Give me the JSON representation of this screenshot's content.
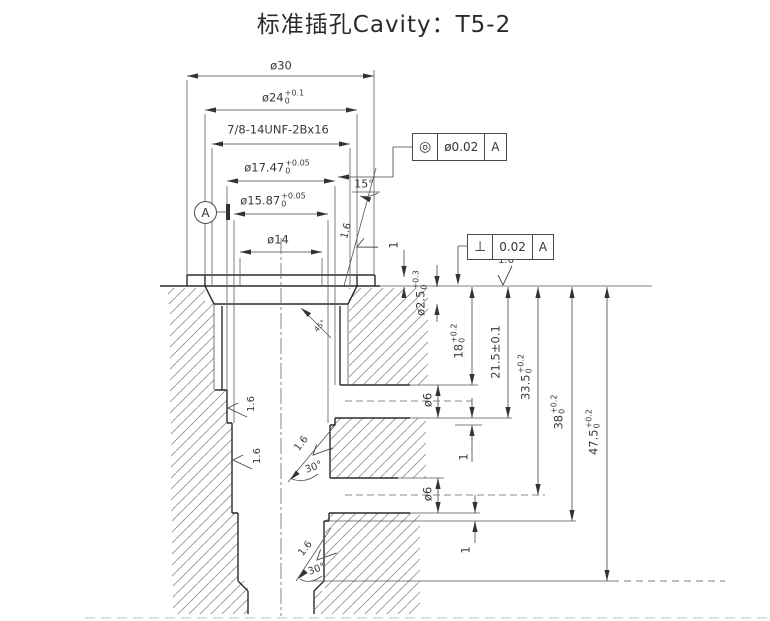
{
  "title": "标准插孔Cavity：T5-2",
  "dims": {
    "d30": {
      "text": "ø30"
    },
    "d24": {
      "text": "ø24",
      "up": "+0.1",
      "dn": "0"
    },
    "thread": {
      "text": "7/8-14UNF-2Bx16"
    },
    "d1747": {
      "text": "ø17.47",
      "up": "+0.05",
      "dn": "0"
    },
    "d1587": {
      "text": "ø15.87",
      "up": "+0.05",
      "dn": "0"
    },
    "d14": {
      "text": "ø14"
    },
    "lip1": {
      "text": "1"
    },
    "d25": {
      "text": "ø2.5",
      "up": "+0.3",
      "dn": "0"
    },
    "d18": {
      "text": "18",
      "up": "+0.2",
      "dn": "0"
    },
    "d215": {
      "text": "21.5±0.1"
    },
    "d335": {
      "text": "33.5",
      "up": "+0.2",
      "dn": "0"
    },
    "d38": {
      "text": "38",
      "up": "+0.2",
      "dn": "0"
    },
    "d475": {
      "text": "47.5",
      "up": "+0.2",
      "dn": "0"
    },
    "port1": {
      "text": "ø6"
    },
    "port2": {
      "text": "ø6"
    },
    "step1": {
      "text": "1"
    },
    "step2": {
      "text": "1"
    }
  },
  "angles": {
    "taper": "15°",
    "seat": "45°",
    "chamfer1": "30°",
    "chamfer2": "30°"
  },
  "finish": {
    "top": "1.6",
    "taper": "1.6",
    "wall1": "1.6",
    "wall2": "1.6",
    "chamfer1": "1.6",
    "chamfer2": "1.6"
  },
  "gdt": {
    "concentricity": {
      "symbol": "◎",
      "tolerance": "ø0.02",
      "datum": "A"
    },
    "perpendicularity": {
      "symbol": "⊥",
      "tolerance": "0.02",
      "datum": "A"
    },
    "datum_label": "A"
  }
}
